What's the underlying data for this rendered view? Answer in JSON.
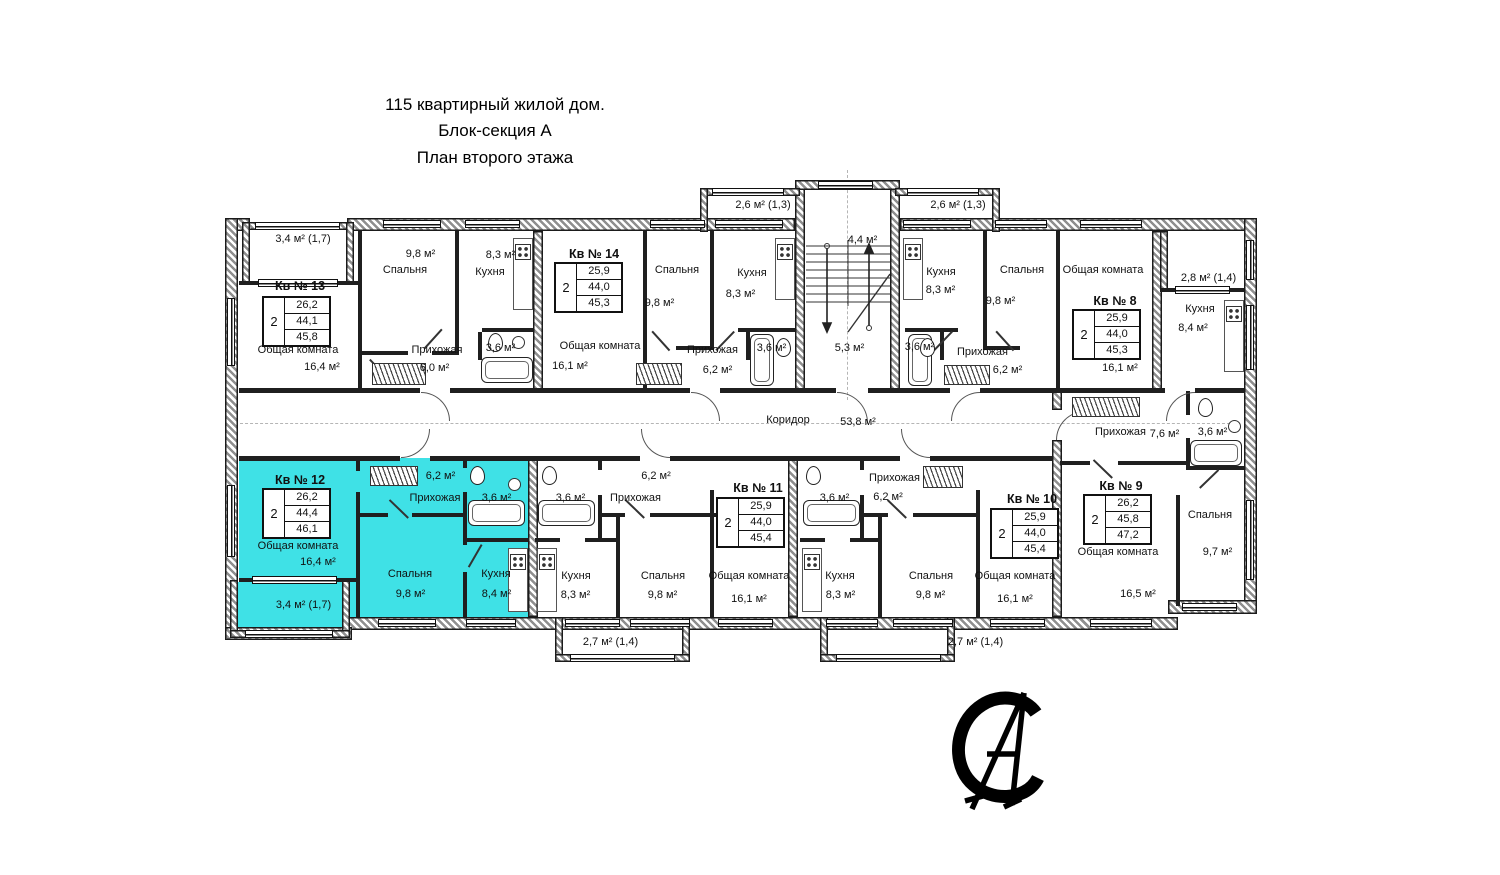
{
  "title": {
    "line1": "115 квартирный жилой дом.",
    "line2": "Блок-секция А",
    "line3": "План второго этажа"
  },
  "colors": {
    "highlight": "#3FE1E6"
  },
  "corridor": {
    "name": "Коридор",
    "area": "53,8 м²"
  },
  "stairwell": {
    "upper_area": "4,4 м²",
    "lower_area": "5,3 м²"
  },
  "apartments": {
    "kv13": {
      "num": "Кв № 13",
      "rooms_count": "2",
      "areas": {
        "living": "26,2",
        "total": "44,1",
        "with_balcony": "45,8"
      },
      "rooms": {
        "living": {
          "name": "Общая комната",
          "area": "16,4 м²"
        },
        "bedroom": {
          "name": "Спальня",
          "area": "9,8 м²"
        },
        "kitchen": {
          "name": "Кухня",
          "area": "8,3 м²"
        },
        "hall": {
          "name": "Прихожая",
          "area": "6,0 м²"
        },
        "bath": {
          "area": "3,6 м²"
        }
      },
      "balcony": "3,4 м²  (1,7)"
    },
    "kv14": {
      "num": "Кв № 14",
      "rooms_count": "2",
      "areas": {
        "living": "25,9",
        "total": "44,0",
        "with_balcony": "45,3"
      },
      "rooms": {
        "living": {
          "name": "Общая комната",
          "area": "16,1 м²"
        },
        "bedroom": {
          "name": "Спальня",
          "area": "9,8 м²"
        },
        "kitchen": {
          "name": "Кухня",
          "area": "8,3 м²"
        },
        "hall": {
          "name": "Прихожая",
          "area": "6,2 м²"
        },
        "bath": {
          "area": "3,6 м²"
        }
      },
      "balcony": "2,6 м²  (1,3)"
    },
    "kv8": {
      "num": "Кв № 8",
      "rooms_count": "2",
      "areas": {
        "living": "25,9",
        "total": "44,0",
        "with_balcony": "45,3"
      },
      "rooms": {
        "living": {
          "name": "Общая комната",
          "area": "16,1 м²"
        },
        "bedroom": {
          "name": "Спальня",
          "area": "9,8 м²"
        },
        "kitchen": {
          "name": "Кухня",
          "area": "8,3 м²"
        },
        "hall": {
          "name": "Прихожая",
          "area": "6,2 м²"
        },
        "bath": {
          "area": "3,6 м²"
        }
      },
      "balcony": "2,6 м²  (1,3)"
    },
    "kv9": {
      "num": "Кв № 9",
      "rooms_count": "2",
      "areas": {
        "living": "26,2",
        "total": "45,8",
        "with_balcony": "47,2"
      },
      "rooms": {
        "living": {
          "name": "Общая комната",
          "area": "16,5 м²"
        },
        "bedroom": {
          "name": "Спальня",
          "area": "9,7 м²"
        },
        "kitchen": {
          "name": "Кухня",
          "area": "8,4 м²"
        },
        "hall": {
          "name": "Прихожая",
          "area": "7,6 м²"
        },
        "bath": {
          "area": "3,6 м²"
        }
      },
      "balcony": "2,8 м² (1,4)"
    },
    "kv12": {
      "num": "Кв № 12",
      "rooms_count": "2",
      "highlighted": true,
      "areas": {
        "living": "26,2",
        "total": "44,4",
        "with_balcony": "46,1"
      },
      "rooms": {
        "living": {
          "name": "Общая комната",
          "area": "16,4 м²"
        },
        "bedroom": {
          "name": "Спальня",
          "area": "9,8 м²"
        },
        "kitchen": {
          "name": "Кухня",
          "area": "8,4 м²"
        },
        "hall": {
          "name": "Прихожая",
          "area": "6,2 м²"
        },
        "bath": {
          "area": "3,6 м²"
        }
      },
      "balcony": "3,4 м²  (1,7)"
    },
    "kv11": {
      "num": "Кв № 11",
      "rooms_count": "2",
      "areas": {
        "living": "25,9",
        "total": "44,0",
        "with_balcony": "45,4"
      },
      "rooms": {
        "living": {
          "name": "Общая комната",
          "area": "16,1 м²"
        },
        "bedroom": {
          "name": "Спальня",
          "area": "9,8 м²"
        },
        "kitchen": {
          "name": "Кухня",
          "area": "8,3 м²"
        },
        "hall": {
          "name": "Прихожая",
          "area": "6,2 м²"
        },
        "bath": {
          "area": "3,6 м²"
        }
      },
      "balcony": "2,7 м² (1,4)"
    },
    "kv10": {
      "num": "Кв № 10",
      "rooms_count": "2",
      "areas": {
        "living": "25,9",
        "total": "44,0",
        "with_balcony": "45,4"
      },
      "rooms": {
        "living": {
          "name": "Общая комната",
          "area": "16,1 м²"
        },
        "bedroom": {
          "name": "Спальня",
          "area": "9,8 м²"
        },
        "kitchen": {
          "name": "Кухня",
          "area": "8,3 м²"
        },
        "hall": {
          "name": "Прихожая",
          "area": "6,2 м²"
        },
        "bath": {
          "area": "3,6 м²"
        }
      },
      "balcony": "2,7 м²  (1,4)"
    }
  }
}
